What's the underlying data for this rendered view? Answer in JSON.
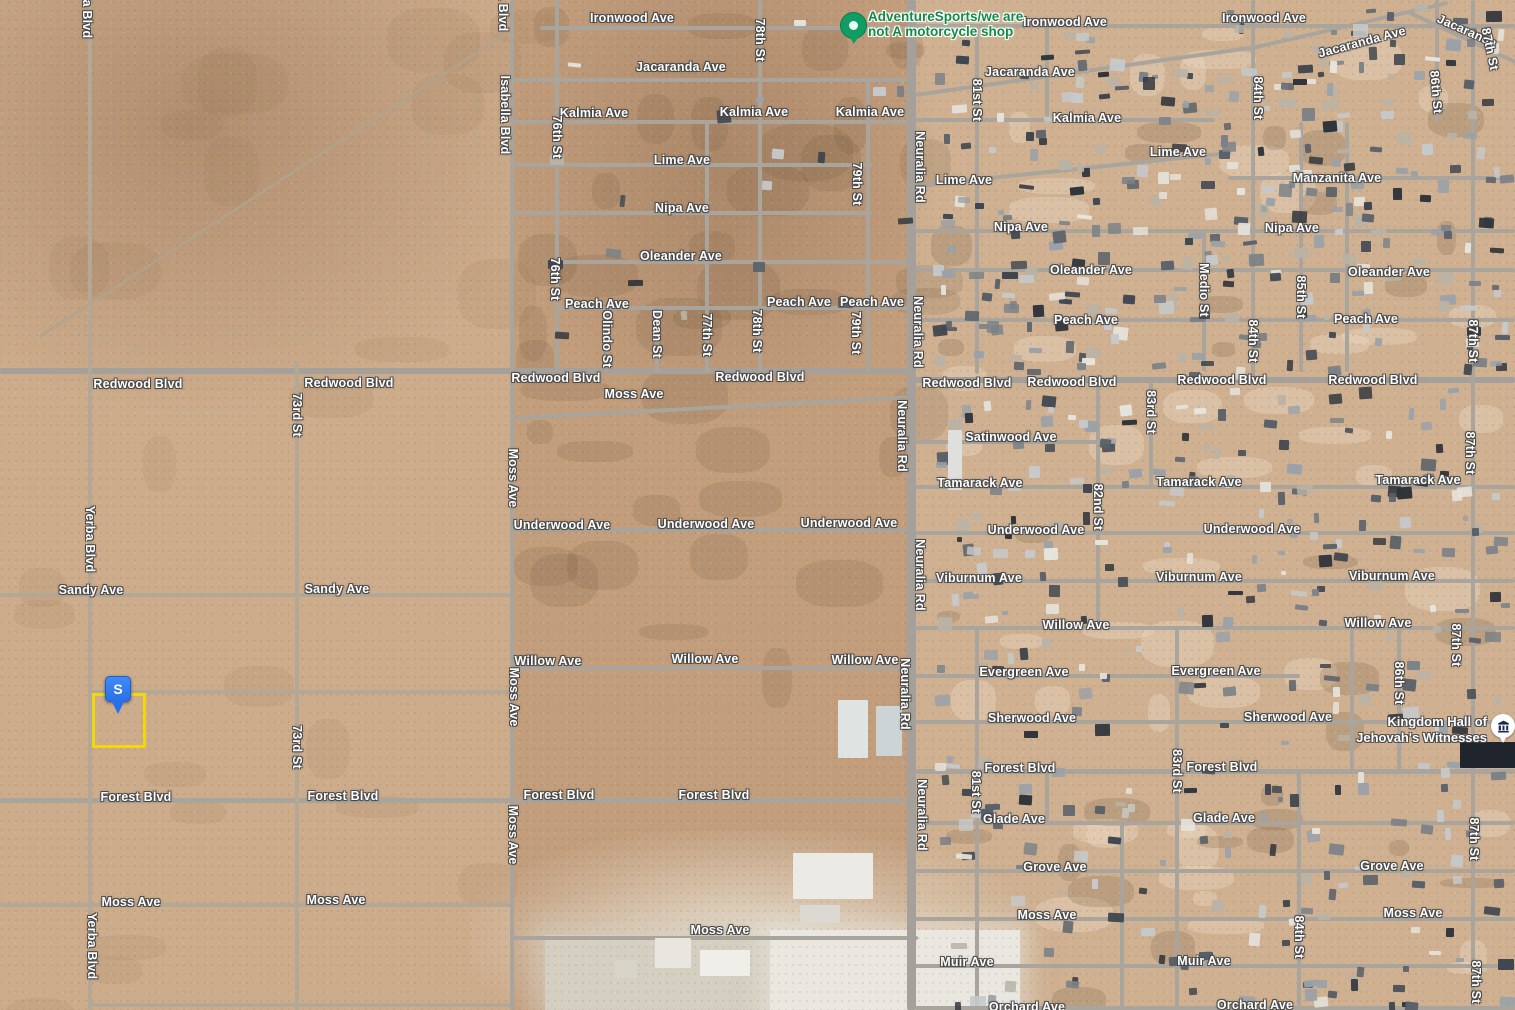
{
  "map": {
    "colors": {
      "desert_base": "#c9a987",
      "road": "#a9a59c",
      "label_text": "#ffffff",
      "business_green": "#128a45",
      "pin_blue": "#2a6fe8",
      "parcel_yellow": "#f2d70c",
      "marker_green": "#0f9d63"
    },
    "business_marker": {
      "line1": "AdventureSports/we are",
      "line2": "not A motorcycle shop"
    },
    "kingdom_hall": {
      "line1": "Kingdom Hall of",
      "line2": "Jehovah's Witnesses"
    },
    "selection_pin": {
      "letter": "S"
    },
    "street_labels": [
      {
        "t": "Ironwood Ave",
        "x": 632,
        "y": 18
      },
      {
        "t": "Ironwood Ave",
        "x": 1065,
        "y": 22
      },
      {
        "t": "Ironwood Ave",
        "x": 1264,
        "y": 18
      },
      {
        "t": "Jacaranda Ave",
        "x": 681,
        "y": 67
      },
      {
        "t": "Jacaranda Ave",
        "x": 1030,
        "y": 72
      },
      {
        "t": "Jacaranda Ave",
        "x": 1362,
        "y": 42,
        "r": -15
      },
      {
        "t": "Jacaranda",
        "x": 1467,
        "y": 31,
        "r": 24
      },
      {
        "t": "Kalmia Ave",
        "x": 594,
        "y": 113
      },
      {
        "t": "Kalmia Ave",
        "x": 754,
        "y": 112
      },
      {
        "t": "Kalmia Ave",
        "x": 870,
        "y": 112
      },
      {
        "t": "Kalmia Ave",
        "x": 1087,
        "y": 118
      },
      {
        "t": "Lime Ave",
        "x": 682,
        "y": 160
      },
      {
        "t": "Lime Ave",
        "x": 964,
        "y": 180
      },
      {
        "t": "Lime Ave",
        "x": 1178,
        "y": 152
      },
      {
        "t": "Manzanita Ave",
        "x": 1337,
        "y": 178
      },
      {
        "t": "Nipa Ave",
        "x": 682,
        "y": 208
      },
      {
        "t": "Nipa Ave",
        "x": 1021,
        "y": 227
      },
      {
        "t": "Nipa Ave",
        "x": 1292,
        "y": 228
      },
      {
        "t": "Oleander Ave",
        "x": 681,
        "y": 256
      },
      {
        "t": "Oleander Ave",
        "x": 1091,
        "y": 270
      },
      {
        "t": "Oleander Ave",
        "x": 1389,
        "y": 272
      },
      {
        "t": "Peach Ave",
        "x": 597,
        "y": 304
      },
      {
        "t": "Peach Ave",
        "x": 799,
        "y": 302
      },
      {
        "t": "Peach Ave",
        "x": 872,
        "y": 302
      },
      {
        "t": "Peach Ave",
        "x": 1086,
        "y": 320
      },
      {
        "t": "Peach Ave",
        "x": 1366,
        "y": 319
      },
      {
        "t": "Redwood Blvd",
        "x": 138,
        "y": 384
      },
      {
        "t": "Redwood Blvd",
        "x": 349,
        "y": 383
      },
      {
        "t": "Redwood Blvd",
        "x": 556,
        "y": 378
      },
      {
        "t": "Redwood Blvd",
        "x": 760,
        "y": 377
      },
      {
        "t": "Redwood Blvd",
        "x": 967,
        "y": 383
      },
      {
        "t": "Redwood Blvd",
        "x": 1072,
        "y": 382
      },
      {
        "t": "Redwood Blvd",
        "x": 1222,
        "y": 380
      },
      {
        "t": "Redwood Blvd",
        "x": 1373,
        "y": 380
      },
      {
        "t": "Moss Ave",
        "x": 634,
        "y": 394
      },
      {
        "t": "Satinwood Ave",
        "x": 1011,
        "y": 437
      },
      {
        "t": "Tamarack Ave",
        "x": 980,
        "y": 483
      },
      {
        "t": "Tamarack Ave",
        "x": 1199,
        "y": 482
      },
      {
        "t": "Tamarack Ave",
        "x": 1418,
        "y": 480
      },
      {
        "t": "Underwood Ave",
        "x": 562,
        "y": 525
      },
      {
        "t": "Underwood Ave",
        "x": 706,
        "y": 524
      },
      {
        "t": "Underwood Ave",
        "x": 849,
        "y": 523
      },
      {
        "t": "Underwood Ave",
        "x": 1036,
        "y": 530
      },
      {
        "t": "Underwood Ave",
        "x": 1252,
        "y": 529
      },
      {
        "t": "Viburnum Ave",
        "x": 979,
        "y": 578
      },
      {
        "t": "Viburnum Ave",
        "x": 1199,
        "y": 577
      },
      {
        "t": "Viburnum Ave",
        "x": 1392,
        "y": 576
      },
      {
        "t": "Sandy Ave",
        "x": 91,
        "y": 590
      },
      {
        "t": "Sandy Ave",
        "x": 337,
        "y": 589
      },
      {
        "t": "Willow Ave",
        "x": 548,
        "y": 661
      },
      {
        "t": "Willow Ave",
        "x": 705,
        "y": 659
      },
      {
        "t": "Willow Ave",
        "x": 865,
        "y": 660
      },
      {
        "t": "Willow Ave",
        "x": 1076,
        "y": 625
      },
      {
        "t": "Willow Ave",
        "x": 1378,
        "y": 623
      },
      {
        "t": "Evergreen Ave",
        "x": 1024,
        "y": 672
      },
      {
        "t": "Evergreen Ave",
        "x": 1216,
        "y": 671
      },
      {
        "t": "Sherwood Ave",
        "x": 1032,
        "y": 718
      },
      {
        "t": "Sherwood Ave",
        "x": 1288,
        "y": 717
      },
      {
        "t": "Forest Blvd",
        "x": 136,
        "y": 797
      },
      {
        "t": "Forest Blvd",
        "x": 343,
        "y": 796
      },
      {
        "t": "Forest Blvd",
        "x": 559,
        "y": 795
      },
      {
        "t": "Forest Blvd",
        "x": 714,
        "y": 795
      },
      {
        "t": "Forest Blvd",
        "x": 1020,
        "y": 768
      },
      {
        "t": "Forest Blvd",
        "x": 1222,
        "y": 767
      },
      {
        "t": "Glade Ave",
        "x": 1014,
        "y": 819
      },
      {
        "t": "Glade Ave",
        "x": 1224,
        "y": 818
      },
      {
        "t": "Grove Ave",
        "x": 1055,
        "y": 867
      },
      {
        "t": "Grove Ave",
        "x": 1392,
        "y": 866
      },
      {
        "t": "Moss Ave",
        "x": 131,
        "y": 902
      },
      {
        "t": "Moss Ave",
        "x": 336,
        "y": 900
      },
      {
        "t": "Moss Ave",
        "x": 720,
        "y": 930
      },
      {
        "t": "Moss Ave",
        "x": 1047,
        "y": 915
      },
      {
        "t": "Moss Ave",
        "x": 1413,
        "y": 913
      },
      {
        "t": "Muir Ave",
        "x": 967,
        "y": 962
      },
      {
        "t": "Muir Ave",
        "x": 1204,
        "y": 961
      },
      {
        "t": "Orchard Ave",
        "x": 1027,
        "y": 1007
      },
      {
        "t": "Orchard Ave",
        "x": 1255,
        "y": 1005
      },
      {
        "t": "Yerba Blvd",
        "x": 87,
        "y": 5,
        "r": 90
      },
      {
        "t": "Yerba Blvd",
        "x": 90,
        "y": 539,
        "r": 90
      },
      {
        "t": "Yerba Blvd",
        "x": 92,
        "y": 946,
        "r": 90
      },
      {
        "t": "73rd St",
        "x": 297,
        "y": 415,
        "r": 90
      },
      {
        "t": "73rd St",
        "x": 297,
        "y": 747,
        "r": 90
      },
      {
        "t": "Isabella Blvd",
        "x": 503,
        "y": -8,
        "r": 90
      },
      {
        "t": "Isabella Blvd",
        "x": 505,
        "y": 115,
        "r": 90
      },
      {
        "t": "Moss Ave",
        "x": 513,
        "y": 478,
        "r": 90
      },
      {
        "t": "Moss Ave",
        "x": 514,
        "y": 697,
        "r": 90
      },
      {
        "t": "Moss Ave",
        "x": 513,
        "y": 835,
        "r": 90
      },
      {
        "t": "76th St",
        "x": 557,
        "y": 137,
        "r": 90
      },
      {
        "t": "76th St",
        "x": 555,
        "y": 279,
        "r": 90
      },
      {
        "t": "Olindo St",
        "x": 607,
        "y": 339,
        "r": 90
      },
      {
        "t": "Dean St",
        "x": 657,
        "y": 334,
        "r": 90
      },
      {
        "t": "77th St",
        "x": 707,
        "y": 335,
        "r": 90
      },
      {
        "t": "78th St",
        "x": 760,
        "y": 40,
        "r": 90
      },
      {
        "t": "78th St",
        "x": 757,
        "y": 331,
        "r": 90
      },
      {
        "t": "79th St",
        "x": 857,
        "y": 184,
        "r": 90
      },
      {
        "t": "79th St",
        "x": 856,
        "y": 333,
        "r": 90
      },
      {
        "t": "Neuralia Rd",
        "x": 920,
        "y": 167,
        "r": 90
      },
      {
        "t": "Neuralia Rd",
        "x": 918,
        "y": 332,
        "r": 90
      },
      {
        "t": "Neuralia Rd",
        "x": 902,
        "y": 436,
        "r": 90
      },
      {
        "t": "Neuralia Rd",
        "x": 920,
        "y": 575,
        "r": 90
      },
      {
        "t": "Neuralia Rd",
        "x": 905,
        "y": 694,
        "r": 90
      },
      {
        "t": "Neuralia Rd",
        "x": 922,
        "y": 815,
        "r": 90
      },
      {
        "t": "81st St",
        "x": 977,
        "y": 100,
        "r": 90
      },
      {
        "t": "81st St",
        "x": 976,
        "y": 792,
        "r": 90
      },
      {
        "t": "82nd St",
        "x": 1098,
        "y": 507,
        "r": 90
      },
      {
        "t": "83rd St",
        "x": 1151,
        "y": 412,
        "r": 90
      },
      {
        "t": "83rd St",
        "x": 1177,
        "y": 771,
        "r": 90
      },
      {
        "t": "84th St",
        "x": 1258,
        "y": 98,
        "r": 90
      },
      {
        "t": "84th St",
        "x": 1253,
        "y": 341,
        "r": 90
      },
      {
        "t": "84th St",
        "x": 1299,
        "y": 937,
        "r": 90
      },
      {
        "t": "85th St",
        "x": 1301,
        "y": 297,
        "r": 90
      },
      {
        "t": "Medio St",
        "x": 1204,
        "y": 290,
        "r": 90
      },
      {
        "t": "86th St",
        "x": 1436,
        "y": 92,
        "r": 85
      },
      {
        "t": "86th St",
        "x": 1399,
        "y": 683,
        "r": 90
      },
      {
        "t": "87th St",
        "x": 1490,
        "y": 49,
        "r": 78
      },
      {
        "t": "87th St",
        "x": 1473,
        "y": 341,
        "r": 90
      },
      {
        "t": "87th St",
        "x": 1470,
        "y": 453,
        "r": 90
      },
      {
        "t": "87th St",
        "x": 1456,
        "y": 645,
        "r": 90
      },
      {
        "t": "87th St",
        "x": 1474,
        "y": 839,
        "r": 90
      },
      {
        "t": "87th St",
        "x": 1476,
        "y": 982,
        "r": 90
      }
    ],
    "roads": [
      {
        "x": 540,
        "y": 26,
        "w": 375,
        "h": 4
      },
      {
        "x": 915,
        "y": 24,
        "w": 600,
        "h": 4
      },
      {
        "x": 512,
        "y": 78,
        "w": 398,
        "h": 4
      },
      {
        "x": 915,
        "y": 93,
        "w": 345,
        "h": 4,
        "r": -8
      },
      {
        "x": 1248,
        "y": 47,
        "w": 205,
        "h": 4,
        "r": -13
      },
      {
        "x": 1408,
        "y": 10,
        "w": 130,
        "h": 4,
        "r": 25
      },
      {
        "x": 512,
        "y": 120,
        "w": 398,
        "h": 4
      },
      {
        "x": 915,
        "y": 118,
        "w": 300,
        "h": 4
      },
      {
        "x": 512,
        "y": 163,
        "w": 360,
        "h": 4
      },
      {
        "x": 915,
        "y": 184,
        "w": 318,
        "h": 4,
        "r": -6
      },
      {
        "x": 1228,
        "y": 176,
        "w": 287,
        "h": 4
      },
      {
        "x": 512,
        "y": 211,
        "w": 360,
        "h": 4
      },
      {
        "x": 915,
        "y": 229,
        "w": 600,
        "h": 4
      },
      {
        "x": 557,
        "y": 260,
        "w": 353,
        "h": 4
      },
      {
        "x": 915,
        "y": 268,
        "w": 600,
        "h": 4
      },
      {
        "x": 557,
        "y": 306,
        "w": 353,
        "h": 4
      },
      {
        "x": 915,
        "y": 318,
        "w": 600,
        "h": 4
      },
      {
        "x": 0,
        "y": 368,
        "w": 912,
        "h": 6,
        "c": "major"
      },
      {
        "x": 908,
        "y": 377,
        "w": 607,
        "h": 6,
        "c": "major"
      },
      {
        "x": 515,
        "y": 416,
        "w": 395,
        "h": 4,
        "r": -3
      },
      {
        "x": 915,
        "y": 440,
        "w": 195,
        "h": 4
      },
      {
        "x": 915,
        "y": 485,
        "w": 600,
        "h": 4
      },
      {
        "x": 512,
        "y": 528,
        "w": 402,
        "h": 4
      },
      {
        "x": 915,
        "y": 531,
        "w": 600,
        "h": 4
      },
      {
        "x": 915,
        "y": 579,
        "w": 600,
        "h": 4
      },
      {
        "x": 0,
        "y": 593,
        "w": 512,
        "h": 4,
        "c": "dirt"
      },
      {
        "x": 512,
        "y": 666,
        "w": 402,
        "h": 4
      },
      {
        "x": 915,
        "y": 626,
        "w": 600,
        "h": 4
      },
      {
        "x": 915,
        "y": 674,
        "w": 385,
        "h": 4
      },
      {
        "x": 90,
        "y": 690,
        "w": 424,
        "h": 4,
        "c": "dirt"
      },
      {
        "x": 915,
        "y": 720,
        "w": 600,
        "h": 4
      },
      {
        "x": 915,
        "y": 769,
        "w": 600,
        "h": 5
      },
      {
        "x": 0,
        "y": 798,
        "w": 914,
        "h": 5
      },
      {
        "x": 915,
        "y": 821,
        "w": 600,
        "h": 4
      },
      {
        "x": 915,
        "y": 869,
        "w": 600,
        "h": 4
      },
      {
        "x": 0,
        "y": 903,
        "w": 514,
        "h": 4,
        "c": "dirt"
      },
      {
        "x": 512,
        "y": 936,
        "w": 406,
        "h": 4
      },
      {
        "x": 915,
        "y": 917,
        "w": 600,
        "h": 4
      },
      {
        "x": 915,
        "y": 964,
        "w": 600,
        "h": 4
      },
      {
        "x": 90,
        "y": 1003,
        "w": 424,
        "h": 4,
        "c": "dirt"
      },
      {
        "x": 915,
        "y": 1006,
        "w": 600,
        "h": 4
      },
      {
        "x": 88,
        "y": 0,
        "w": 4,
        "h": 1010,
        "c": "dirt"
      },
      {
        "x": 295,
        "y": 362,
        "w": 4,
        "h": 648,
        "c": "dirt"
      },
      {
        "x": 510,
        "y": 0,
        "w": 4,
        "h": 1010
      },
      {
        "x": 555,
        "y": 0,
        "w": 4,
        "h": 372
      },
      {
        "x": 605,
        "y": 308,
        "w": 4,
        "h": 64
      },
      {
        "x": 655,
        "y": 308,
        "w": 4,
        "h": 64
      },
      {
        "x": 705,
        "y": 122,
        "w": 4,
        "h": 250
      },
      {
        "x": 758,
        "y": 0,
        "w": 4,
        "h": 372
      },
      {
        "x": 866,
        "y": 80,
        "w": 4,
        "h": 292
      },
      {
        "x": 907,
        "y": 0,
        "w": 9,
        "h": 1010,
        "c": "major"
      },
      {
        "x": 975,
        "y": 24,
        "w": 4,
        "h": 350
      },
      {
        "x": 975,
        "y": 626,
        "w": 4,
        "h": 384
      },
      {
        "x": 1045,
        "y": 24,
        "w": 4,
        "h": 96
      },
      {
        "x": 1096,
        "y": 382,
        "w": 4,
        "h": 246
      },
      {
        "x": 1149,
        "y": 382,
        "w": 4,
        "h": 105
      },
      {
        "x": 1175,
        "y": 626,
        "w": 4,
        "h": 384
      },
      {
        "x": 1202,
        "y": 231,
        "w": 4,
        "h": 140
      },
      {
        "x": 1251,
        "y": 0,
        "w": 4,
        "h": 380
      },
      {
        "x": 1297,
        "y": 771,
        "w": 4,
        "h": 239
      },
      {
        "x": 1299,
        "y": 122,
        "w": 4,
        "h": 250
      },
      {
        "x": 1345,
        "y": 122,
        "w": 4,
        "h": 250
      },
      {
        "x": 1350,
        "y": 626,
        "w": 4,
        "h": 145
      },
      {
        "x": 1435,
        "y": 0,
        "w": 4,
        "h": 122
      },
      {
        "x": 1397,
        "y": 626,
        "w": 4,
        "h": 145
      },
      {
        "x": 1471,
        "y": 0,
        "w": 4,
        "h": 1010
      },
      {
        "x": 1120,
        "y": 821,
        "w": 4,
        "h": 189
      },
      {
        "x": 1045,
        "y": 769,
        "w": 4,
        "h": 52
      },
      {
        "x": 40,
        "y": 335,
        "w": 560,
        "h": 3,
        "r": -33,
        "c": "trail"
      }
    ]
  }
}
